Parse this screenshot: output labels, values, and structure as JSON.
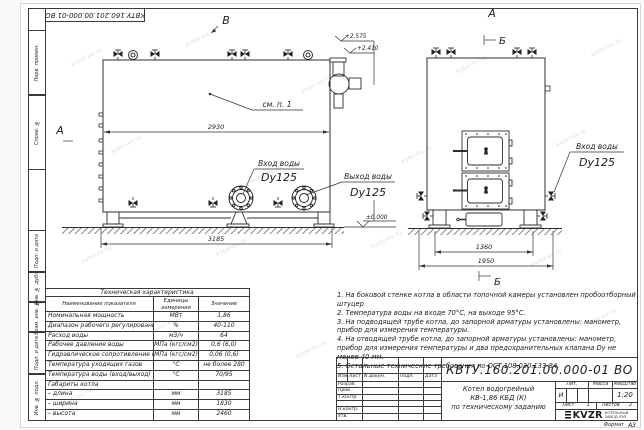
{
  "page": {
    "watermark": "kotel-kv.ru",
    "format_label": "Формат",
    "format_value": "А3"
  },
  "margins": {
    "labels": [
      "Перв. примен.",
      "Справ. №",
      "Подп. и дата",
      "Инв. № дубл.",
      "Взам. инв. №",
      "Подп. и дата",
      "Инв. № подл."
    ]
  },
  "drawing": {
    "view_labels": {
      "v": "В",
      "a_left": "А",
      "a_right": "А",
      "b_top": "Б",
      "b_bottom": "Б"
    },
    "callout": "см. п. 1",
    "dims": {
      "width_top": "2930",
      "length": "3185",
      "front_inner": "1360",
      "front_outer": "1950"
    },
    "elevations": {
      "top": "+2.575",
      "mid": "+2.410",
      "zero": "±0.000"
    },
    "ports": {
      "inlet_left": {
        "line1": "Вход воды",
        "line2": "Dy125"
      },
      "outlet": {
        "line1": "Выход воды",
        "line2": "Dy125"
      },
      "inlet_right": {
        "line1": "Вход воды",
        "line2": "Dy125"
      }
    }
  },
  "tech_table": {
    "title": "Техническая характеристика",
    "headers": [
      "Наименование показателя",
      "Единицы измерения",
      "Значение"
    ],
    "rows": [
      [
        "Номинальная мощность",
        "МВт",
        "1,86"
      ],
      [
        "Диапазон рабочего регулирования",
        "%",
        "40-110"
      ],
      [
        "Расход воды",
        "м3/ч",
        "64"
      ],
      [
        "Рабочее давление воды",
        "МПа (кгс/см2)",
        "0,6 (6,0)"
      ],
      [
        "Гидравлическое сопротивление котла",
        "МПа (кгс/см2)",
        "0,06 (0,6)"
      ],
      [
        "Температура уходящих газов",
        "°С",
        "не более 280"
      ],
      [
        "Температура воды (вход/выход)",
        "°С",
        "70/95"
      ],
      [
        "Габариты котла",
        "",
        ""
      ],
      [
        "– длина",
        "мм",
        "3185"
      ],
      [
        "– ширина",
        "мм",
        "1830"
      ],
      [
        "– высота",
        "мм",
        "2460"
      ]
    ]
  },
  "notes": {
    "items": [
      "1.  На боковой стенке котла в области топочной камеры установлен пробоотборный штуцер",
      "2.  Температура воды на входе 70°С, на выходе 95°С.",
      "3.  На подводящей трубе котла, до запорной арматуры установлены: манометр, прибор для измерения температуры.",
      "4.  На отводящей трубе котла, до запорной арматуры установлены: манометр, прибор для измерения температуры и два предохранительных клапана Dy не менее 40 мм.",
      "5.  Остальные технические требования по ОСТ 108.030.133-84."
    ]
  },
  "title_block": {
    "doc_number": "КВТУ.160.201.00.000-01 ВО",
    "change_headers": [
      "Изм.",
      "Лист",
      "N докум.",
      "Подп.",
      "Дата"
    ],
    "sign_rows": [
      "Разраб.",
      "Пров.",
      "Т.контр.",
      "",
      "Н.контр.",
      "Утв."
    ],
    "title_line1": "Котел водогрейный",
    "title_line2": "КВ-1,86 КБД (К)",
    "title_line3": "по техническому заданию",
    "lit_header": "Лит.",
    "lit_value": "И",
    "mass_header": "Масса",
    "scale_header": "Масштаб",
    "scale_value": "1:20",
    "sheet_label": "Лист",
    "sheet_value": "1",
    "sheets_label": "Листов",
    "sheets_value": "2",
    "logo_text": "KVZR",
    "logo_caption_line1": "КОТЕЛЬНЫЙ",
    "logo_caption_line2": "ЗАВОД РЭП"
  }
}
